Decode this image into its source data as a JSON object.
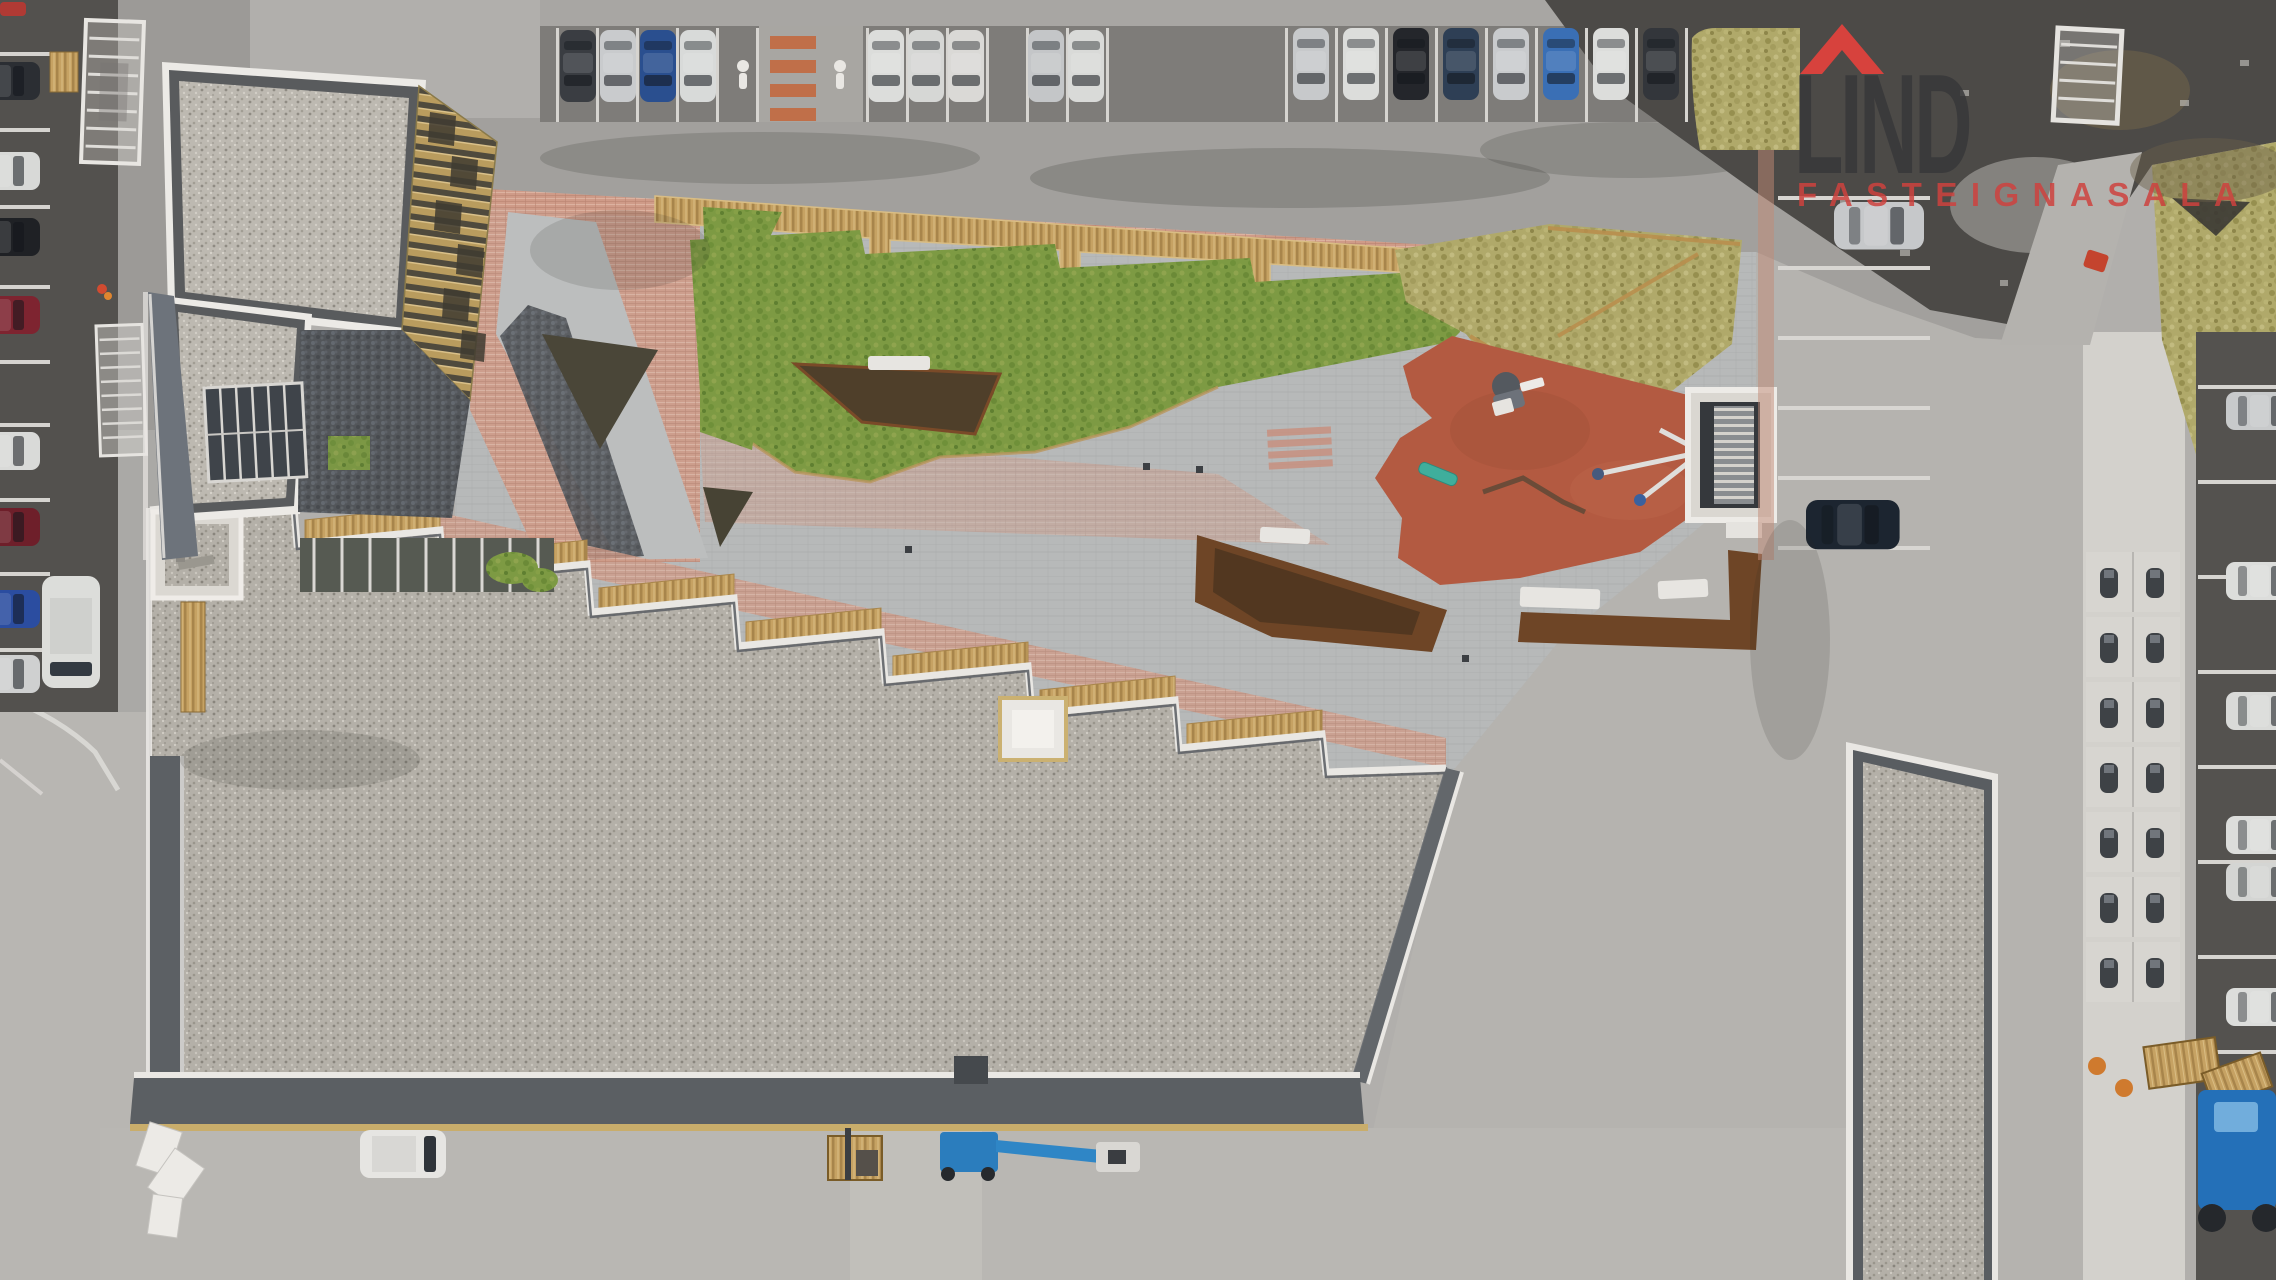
{
  "watermark": {
    "brand_text": "LIND",
    "brand_subtext": "FASTEIGNASALA",
    "roof_icon": "red-house-roof-icon",
    "brand_text_color": "#3a3a3e",
    "subtext_color": "#cc4b48",
    "roof_color": "#e2423c"
  },
  "scene": {
    "type": "aerial-drone-photograph",
    "subject": "apartment complex courtyard with playground, gravel roofs and parking lots",
    "palette": {
      "asphalt_dark": "#53514e",
      "asphalt_light": "#a2a09d",
      "concrete_road": "#b8b6b2",
      "sidewalk": "#d3d1cc",
      "gravel_roof": "#bdb9b1",
      "roof_trim_dark": "#5b5f63",
      "roof_trim_white": "#e9e7e3",
      "facade_wood": "#b99c5e",
      "slate_siding": "#6d737b",
      "lawn_green": "#7d9a43",
      "dry_grass": "#b0a96a",
      "pink_paving": "#cf9b88",
      "gray_pavers": "#b7b9b9",
      "playground_red": "#b35a41",
      "corten_steel": "#6e4526",
      "bench_teal": "#3fae9c",
      "lift_blue": "#2b7dbd",
      "tractor_blue": "#2470b8",
      "pallet_wood": "#c6a263"
    },
    "regions": [
      {
        "name": "top-parking-row",
        "description": "perpendicular parking with cars"
      },
      {
        "name": "pedestrian-crossing",
        "description": "walkway with two pedestrian markings and orange stripes"
      },
      {
        "name": "north-building",
        "description": "gravel flat roof with wooden louvre facade"
      },
      {
        "name": "south-building",
        "description": "long gravel roof, sawtooth edge with wood benches"
      },
      {
        "name": "east-building",
        "description": "gravel roof wing at bottom right"
      },
      {
        "name": "courtyard-lawn",
        "description": "green lawn with terraced wooden edge"
      },
      {
        "name": "dry-grass-area",
        "description": "newly laid turf, upper right courtyard"
      },
      {
        "name": "red-playground",
        "description": "terracotta safety surface with play equipment"
      },
      {
        "name": "stair-enclosure",
        "description": "white framed stairwell to parking"
      },
      {
        "name": "corten-planters",
        "description": "rust steel planter edges with white benches"
      },
      {
        "name": "scooter-stalls",
        "description": "grid of marked stalls on right sidewalk"
      },
      {
        "name": "right-street-parking",
        "description": "parking bays with white cars, right edge"
      },
      {
        "name": "left-street-parking",
        "description": "parallel parking column, left edge"
      },
      {
        "name": "service-vehicles",
        "description": "trailer, forklift, blue boom lift, white van, blue tractor, pallets"
      }
    ],
    "vehicle_counts": {
      "top_row_cars": 16,
      "left_column_cars": 8,
      "right_edge_cars": 6,
      "courtyard_side_cars": 2
    }
  }
}
